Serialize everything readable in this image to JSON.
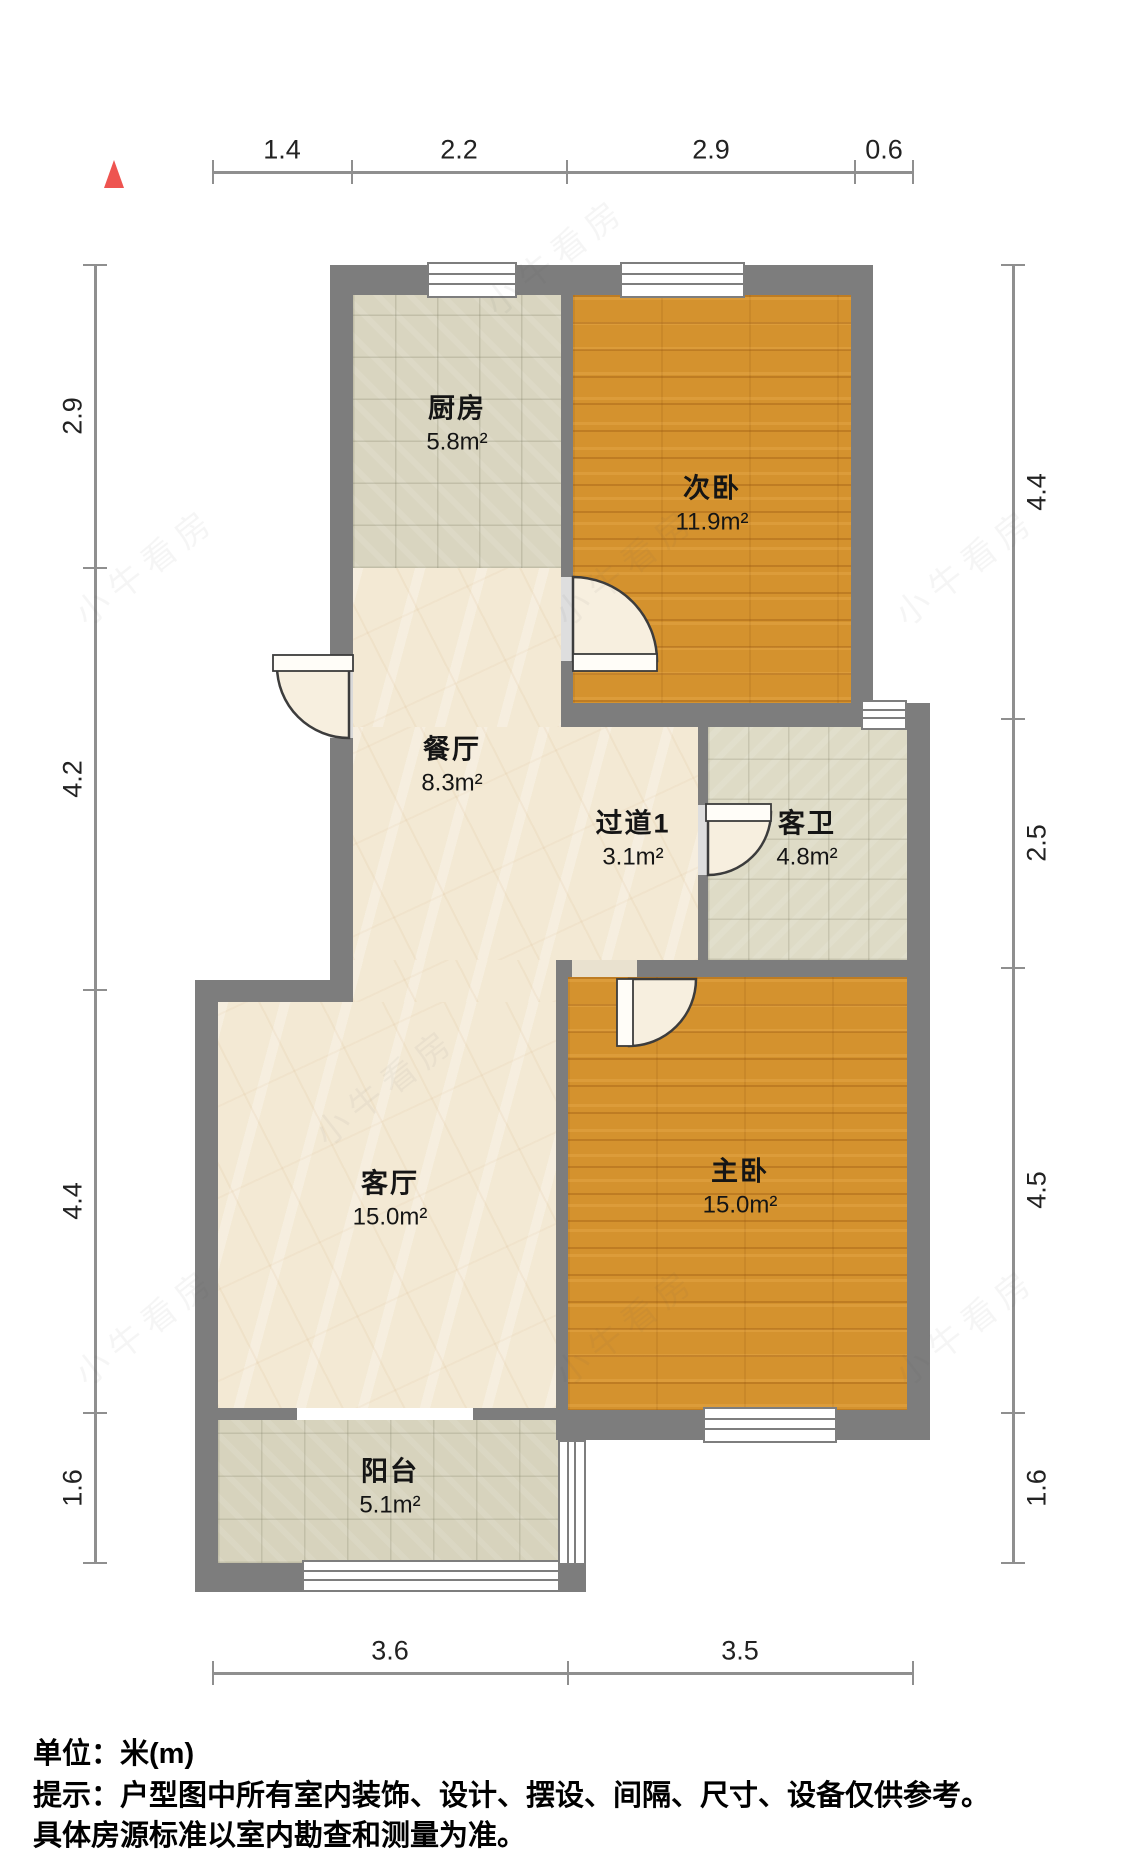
{
  "meta": {
    "type": "floorplan",
    "unit_label": "单位：米(m)",
    "watermark_text": "小牛看房",
    "colors": {
      "wall": "#7d7d7d",
      "wood_floor": "#d4922e",
      "marble_floor": "#f3e9d4",
      "tile_floor": "#d9d5c0",
      "north_arrow": "#ee5450",
      "dim_line": "#8f8f8f",
      "text": "#151515"
    }
  },
  "rooms": [
    {
      "id": "kitchen",
      "name": "厨房",
      "area": "5.8m²",
      "x": 457,
      "y": 425
    },
    {
      "id": "second-bedroom",
      "name": "次卧",
      "area": "11.9m²",
      "x": 712,
      "y": 505
    },
    {
      "id": "dining-room",
      "name": "餐厅",
      "area": "8.3m²",
      "x": 452,
      "y": 766
    },
    {
      "id": "hallway",
      "name": "过道1",
      "area": "3.1m²",
      "x": 633,
      "y": 840
    },
    {
      "id": "guest-bathroom",
      "name": "客卫",
      "area": "4.8m²",
      "x": 807,
      "y": 840
    },
    {
      "id": "living-room",
      "name": "客厅",
      "area": "15.0m²",
      "x": 390,
      "y": 1200
    },
    {
      "id": "master-bedroom",
      "name": "主卧",
      "area": "15.0m²",
      "x": 740,
      "y": 1188
    },
    {
      "id": "balcony",
      "name": "阳台",
      "area": "5.1m²",
      "x": 390,
      "y": 1488
    }
  ],
  "dimensions": {
    "top": {
      "axis": "x",
      "line": 172,
      "from": 213,
      "to": 913,
      "ticks": [
        213,
        352,
        567,
        855,
        913
      ],
      "labels": [
        {
          "t": "1.4",
          "p": 282
        },
        {
          "t": "2.2",
          "p": 459
        },
        {
          "t": "2.9",
          "p": 711
        },
        {
          "t": "0.6",
          "p": 884
        }
      ]
    },
    "left": {
      "axis": "y",
      "line": 95,
      "from": 265,
      "to": 1563,
      "ticks": [
        265,
        568,
        990,
        1413,
        1563
      ],
      "labels": [
        {
          "t": "2.9",
          "p": 416
        },
        {
          "t": "4.2",
          "p": 779
        },
        {
          "t": "4.4",
          "p": 1201
        },
        {
          "t": "1.6",
          "p": 1488
        }
      ]
    },
    "right": {
      "axis": "y",
      "line": 1013,
      "from": 265,
      "to": 1563,
      "ticks": [
        265,
        719,
        968,
        1413,
        1563
      ],
      "labels": [
        {
          "t": "4.4",
          "p": 492
        },
        {
          "t": "2.5",
          "p": 843
        },
        {
          "t": "4.5",
          "p": 1190
        },
        {
          "t": "1.6",
          "p": 1488
        }
      ]
    },
    "bottom": {
      "axis": "x",
      "line": 1673,
      "from": 213,
      "to": 913,
      "ticks": [
        213,
        568,
        913
      ],
      "labels": [
        {
          "t": "3.6",
          "p": 390
        },
        {
          "t": "3.5",
          "p": 740
        }
      ]
    }
  },
  "footer": {
    "unit_line": "单位：米(m)",
    "tip_line1": "提示：户型图中所有室内装饰、设计、摆设、间隔、尺寸、设备仅供参考。",
    "tip_line2": "具体房源标准以室内勘查和测量为准。"
  },
  "plan": {
    "floors": [
      {
        "id": "kitchen-floor",
        "type": "tile-kitchen",
        "x": 353,
        "y": 295,
        "w": 208,
        "h": 273
      },
      {
        "id": "second-bedroom-floor",
        "type": "wood",
        "x": 573,
        "y": 295,
        "w": 278,
        "h": 408
      },
      {
        "id": "dining-floor-upper",
        "type": "marble",
        "x": 353,
        "y": 568,
        "w": 208,
        "h": 159
      },
      {
        "id": "dining-hall-floor",
        "type": "marble",
        "x": 353,
        "y": 727,
        "w": 345,
        "h": 233
      },
      {
        "id": "dining-floor-lower",
        "type": "marble",
        "x": 353,
        "y": 960,
        "w": 203,
        "h": 42
      },
      {
        "id": "living-room-floor",
        "type": "marble",
        "x": 218,
        "y": 1002,
        "w": 338,
        "h": 406
      },
      {
        "id": "guest-bathroom-floor",
        "type": "tile-bath",
        "x": 708,
        "y": 727,
        "w": 199,
        "h": 233
      },
      {
        "id": "master-bedroom-floor",
        "type": "wood",
        "x": 568,
        "y": 977,
        "w": 339,
        "h": 433
      },
      {
        "id": "balcony-floor",
        "type": "tile-balcony",
        "x": 218,
        "y": 1420,
        "w": 342,
        "h": 143
      }
    ],
    "walls": [
      {
        "id": "wall-top",
        "x": 330,
        "y": 265,
        "w": 543,
        "h": 30
      },
      {
        "id": "wall-upper-left-a",
        "x": 330,
        "y": 295,
        "w": 23,
        "h": 365
      },
      {
        "id": "wall-upper-left-b",
        "x": 330,
        "y": 738,
        "w": 23,
        "h": 242
      },
      {
        "id": "wall-step",
        "x": 195,
        "y": 980,
        "w": 158,
        "h": 22
      },
      {
        "id": "wall-lower-left",
        "x": 195,
        "y": 1002,
        "w": 23,
        "h": 590
      },
      {
        "id": "wall-kitchen-divider-a",
        "x": 561,
        "y": 295,
        "w": 12,
        "h": 282
      },
      {
        "id": "wall-kitchen-divider-b",
        "x": 561,
        "y": 661,
        "w": 12,
        "h": 66
      },
      {
        "id": "wall-bedroom2-right",
        "x": 851,
        "y": 295,
        "w": 22,
        "h": 408
      },
      {
        "id": "wall-bedroom2-bottom-a",
        "x": 561,
        "y": 703,
        "w": 300,
        "h": 24
      },
      {
        "id": "wall-bedroom2-bottom-b",
        "x": 907,
        "y": 703,
        "w": 23,
        "h": 24
      },
      {
        "id": "wall-bath-right",
        "x": 907,
        "y": 727,
        "w": 23,
        "h": 250
      },
      {
        "id": "wall-hall-bath-divider-a",
        "x": 698,
        "y": 727,
        "w": 10,
        "h": 78
      },
      {
        "id": "wall-hall-bath-divider-b",
        "x": 698,
        "y": 875,
        "w": 10,
        "h": 85
      },
      {
        "id": "wall-master-top-a",
        "x": 556,
        "y": 960,
        "w": 16,
        "h": 17
      },
      {
        "id": "wall-master-top-b",
        "x": 637,
        "y": 960,
        "w": 293,
        "h": 17
      },
      {
        "id": "wall-master-left",
        "x": 556,
        "y": 977,
        "w": 12,
        "h": 433
      },
      {
        "id": "wall-master-right",
        "x": 907,
        "y": 977,
        "w": 23,
        "h": 463
      },
      {
        "id": "wall-master-bottom-a",
        "x": 556,
        "y": 1410,
        "w": 147,
        "h": 30
      },
      {
        "id": "wall-master-bottom-b",
        "x": 837,
        "y": 1410,
        "w": 93,
        "h": 30
      },
      {
        "id": "wall-living-balcony-a",
        "x": 195,
        "y": 1408,
        "w": 102,
        "h": 12
      },
      {
        "id": "wall-living-balcony-b",
        "x": 473,
        "y": 1408,
        "w": 87,
        "h": 12
      },
      {
        "id": "wall-balcony-right-top",
        "x": 560,
        "y": 1420,
        "w": 26,
        "h": 20
      },
      {
        "id": "wall-balcony-bottom-left",
        "x": 195,
        "y": 1563,
        "w": 107,
        "h": 29
      },
      {
        "id": "wall-balcony-bottom-right",
        "x": 560,
        "y": 1563,
        "w": 26,
        "h": 29
      }
    ],
    "thresholds": [
      {
        "id": "entry-threshold",
        "x": 330,
        "y": 660,
        "w": 23,
        "h": 78,
        "c": "#d9d9d9"
      },
      {
        "id": "bedroom2-threshold",
        "x": 561,
        "y": 577,
        "w": 12,
        "h": 84,
        "c": "#dedede"
      },
      {
        "id": "bath-threshold",
        "x": 698,
        "y": 805,
        "w": 10,
        "h": 70,
        "c": "#dedede"
      },
      {
        "id": "master-threshold",
        "x": 572,
        "y": 960,
        "w": 65,
        "h": 17,
        "c": "#e9e1cf"
      }
    ],
    "windows": [
      {
        "id": "window-kitchen-top",
        "x": 427,
        "y": 262,
        "w": 90,
        "h": 36,
        "o": "h"
      },
      {
        "id": "window-bedroom2-top",
        "x": 620,
        "y": 262,
        "w": 125,
        "h": 36,
        "o": "h"
      },
      {
        "id": "window-bathroom-top",
        "x": 861,
        "y": 700,
        "w": 46,
        "h": 30,
        "o": "h"
      },
      {
        "id": "window-master-bottom",
        "x": 703,
        "y": 1407,
        "w": 134,
        "h": 36,
        "o": "h"
      },
      {
        "id": "window-balcony-right",
        "x": 558,
        "y": 1440,
        "w": 28,
        "h": 125,
        "o": "v"
      },
      {
        "id": "window-balcony-bottom",
        "x": 302,
        "y": 1560,
        "w": 258,
        "h": 32,
        "o": "h"
      }
    ],
    "doors": [
      {
        "id": "entry-door",
        "disc": "M 349 666 L 277 666 A 72 72 0 0 0 349 738 Z",
        "leaf": {
          "x": 273,
          "y": 655,
          "w": 80,
          "h": 16
        }
      },
      {
        "id": "bedroom2-door",
        "disc": "M 573 661 L 573 577 A 84 84 0 0 1 657 661 Z",
        "leaf": {
          "x": 573,
          "y": 654,
          "w": 84,
          "h": 17
        }
      },
      {
        "id": "bathroom-door",
        "disc": "M 708 812 L 771 812 A 63 63 0 0 1 708 875 Z",
        "leaf": {
          "x": 706,
          "y": 804,
          "w": 65,
          "h": 17
        }
      },
      {
        "id": "master-door",
        "disc": "M 629 979 L 629 1046 A 67 67 0 0 0 696 979 Z",
        "leaf": {
          "x": 617,
          "y": 979,
          "w": 16,
          "h": 67
        }
      }
    ],
    "watermarks": [
      {
        "x": 470,
        "y": 230
      },
      {
        "x": 60,
        "y": 540
      },
      {
        "x": 540,
        "y": 540
      },
      {
        "x": 880,
        "y": 540
      },
      {
        "x": 300,
        "y": 1060
      },
      {
        "x": 540,
        "y": 1300
      },
      {
        "x": 880,
        "y": 1300
      },
      {
        "x": 60,
        "y": 1300
      }
    ]
  }
}
